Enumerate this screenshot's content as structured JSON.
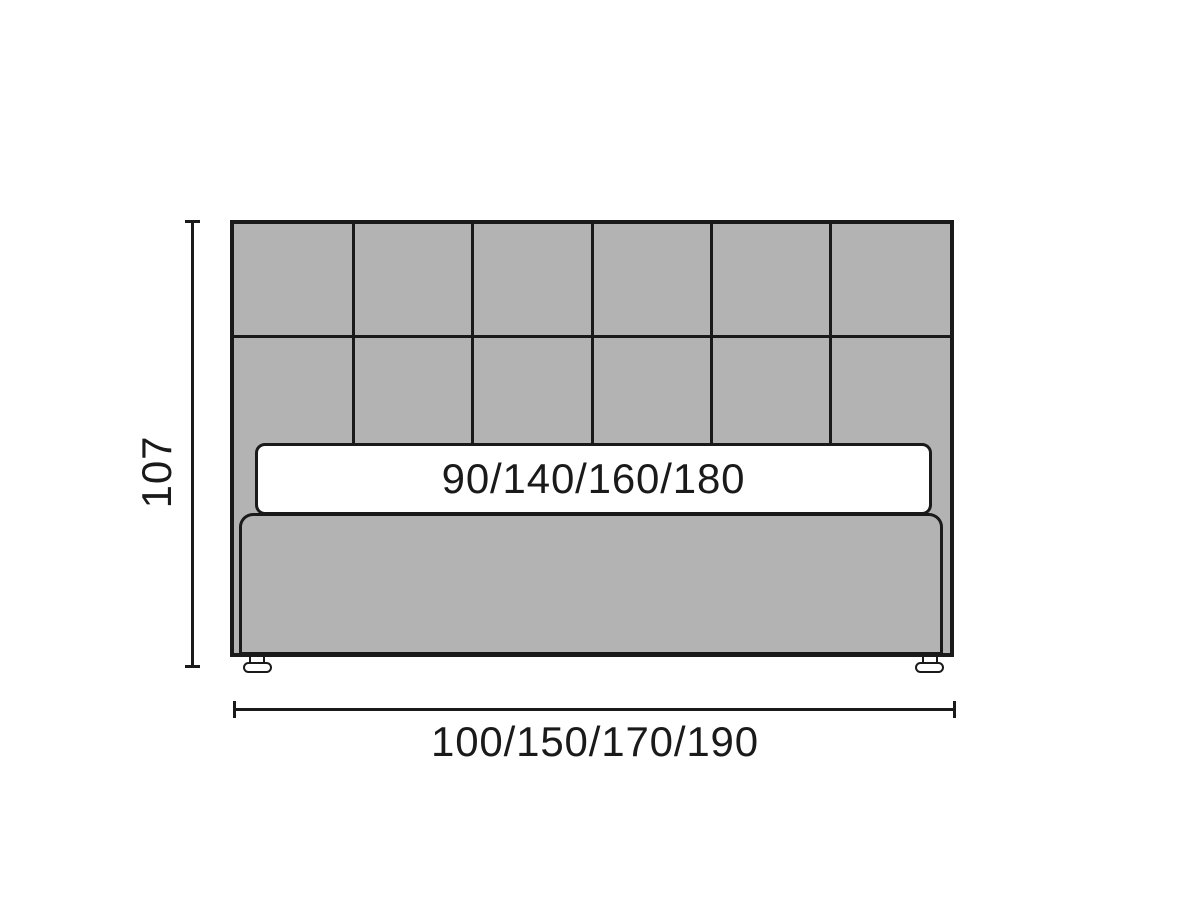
{
  "labels": {
    "height": "107",
    "mattress_widths": "90/140/160/180",
    "bed_widths": "100/150/170/190"
  },
  "headboard": {
    "grid_columns": 6,
    "grid_rows": 2
  },
  "colors": {
    "line": "#1a1a1a",
    "upholstery": "#b3b3b3",
    "background": "#ffffff",
    "surface": "#ffffff"
  }
}
